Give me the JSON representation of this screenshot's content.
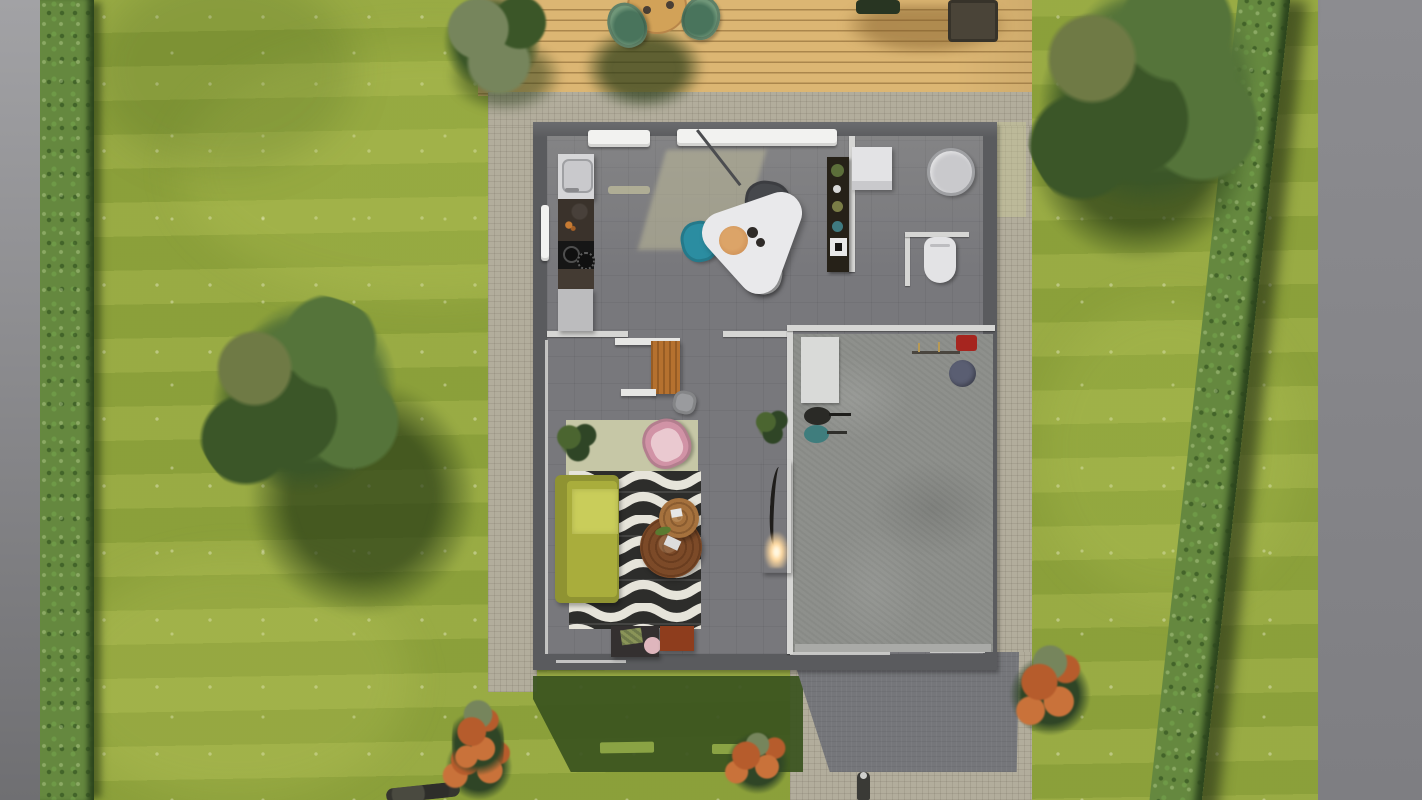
{
  "scene": {
    "title": "Aerial top-down 3D render of a single-storey house with garden, deck and garage",
    "view": "top-down orthographic",
    "palette": {
      "gray_left": "#a2a2a5",
      "gray_left_dark": "#6f6f72",
      "gray_right": "#8c8c90",
      "lawn": "#94a73e",
      "speckle": "rgba(246,246,224,0.38)",
      "speckle2": "rgba(255,255,235,0.30)",
      "hedge": "#65883f",
      "hedge_dark": "#2c451d",
      "deck": "#dcb673",
      "deck_line": "rgba(130,95,45,0.55)",
      "deck_table": "#d2a258",
      "deck_chair": "#6f9678",
      "deck_chair_dark": "#49745c",
      "deck_furniture_dark": "#283522",
      "deck_furniture_brown": "#4a4438",
      "concrete": "#b2ad9c",
      "concrete_line": "rgba(90,85,70,0.14)",
      "shadow_green": "#3a531e",
      "shadow_slit": "#8aa344",
      "driveway": "#75767a",
      "wall": "#5a5b5e",
      "wall_inner": "#d6d6d4",
      "floor": "#78787c",
      "floor_light_patch": "rgba(203,200,160,0.45)",
      "window_white": "#f2f2f0",
      "garage_floor": "#8e908c",
      "garage_mat": "#d9dad8",
      "fixture_white": "#e3e3e5",
      "fixture_gray": "#c9c9cc",
      "basin_ring": "#9fa0a3",
      "sink_white": "#d6d6d8",
      "counter_dark": "#3a322b",
      "cooktop": "#161616",
      "cabinet_light": "#bcbcbe",
      "table_white": "#e9e9eb",
      "chair_teal": "#2b8da1",
      "chair_dark_gray": "#46484c",
      "chair_white": "#dadbdd",
      "plate": "#cf9157",
      "shelf_dark": "#262118",
      "desk_orange": "#b5712f",
      "shelf_white": "#e6e6e4",
      "rug_beige": "#c6c7a6",
      "chair_pink": "#d193a6",
      "chair_pink_light": "#eac9d0",
      "rug_black": "#2d2d2b",
      "rug_white": "#e6e4da",
      "sofa": "#a9ad3c",
      "sofa_light": "#c9cd5a",
      "sofa_dark": "#8f9332",
      "wood_dark": "#7c4a28",
      "wood_light": "#a5713d",
      "console_dark": "#343030",
      "rust": "#8e3d1d",
      "fireplace": "#c1661f",
      "flame": "#ffd9a0",
      "plant_dark": "#2f4526",
      "plant_green": "#4b6530",
      "tree_green": "#55743a",
      "tree_green_dark": "#3b5628",
      "tree_olive": "#6f7a45",
      "tree_shadow": "rgba(36,56,20,0.85)",
      "shrub_gray": "#76855c",
      "bush_orange": "#b65c2c",
      "bush_orange2": "#c9723a",
      "vac_black": "#2a2a26",
      "vac_teal": "#3f7d7d",
      "navy": "#5a5e72",
      "red_item": "#a6251f",
      "figure_dark": "#3a3a36"
    },
    "exterior": {
      "ground": [
        "lawn with daisy speckles",
        "gray boundary strip left",
        "gray boundary area right",
        "left hedge row",
        "diagonal right hedge row",
        "concrete tile apron around house",
        "dark driveway bottom-right",
        "house shadow on lawn with two window light slits"
      ],
      "deck": {
        "objects": [
          "round wooden table",
          "two cups",
          "green shell chair left",
          "green shell chair right",
          "dark lounger (edge of frame)",
          "dark brown side furniture (edge of frame)",
          "chair shadows"
        ]
      },
      "plants": [
        "large tree on left lawn",
        "large tree top-right",
        "gray-green shrub overhanging deck top-left",
        "red flowering bush bottom-left",
        "red flowering bush bottom-center",
        "flowering bush bottom-right",
        "corner shrub at apron bottom-left"
      ],
      "props": [
        "small statue on path below driveway",
        "dark object at bottom-left edge"
      ]
    },
    "house": {
      "architecture": [
        "dark perimeter walls",
        "two top windows",
        "left wall window",
        "interior partition walls",
        "wc enclosure walls",
        "door openings",
        "white wall-top highlights"
      ],
      "kitchen": {
        "objects": [
          "sink unit with basin",
          "dark stone counter",
          "black cooktop with burners",
          "dark counter section",
          "light base cabinet"
        ]
      },
      "dining": {
        "objects": [
          "white triangular table",
          "teal chair",
          "dark gray chair",
          "white chair",
          "wooden plate with cups",
          "pendant lamp cable",
          "tall dark shelf with decor",
          "sunlight patch on floor"
        ]
      },
      "bathroom": {
        "objects": [
          "white washing machine",
          "round shower basin",
          "toilet"
        ]
      },
      "living_room": {
        "objects": [
          "white wall shelves",
          "orange wood desk",
          "gray desk chair",
          "beige area rug",
          "pink armchair",
          "houseplant left",
          "black & white wave rug",
          "chartreuse sofa with throw",
          "large round coffee table",
          "small round coffee table",
          "dark media console with decor",
          "rust storage cube",
          "orange fireplace with flame",
          "potted plant by wall"
        ]
      },
      "garage": {
        "objects": [
          "white floor mat",
          "red wall-mounted box",
          "tool rail",
          "dark blue bucket",
          "black canister vacuum",
          "teal canister vacuum"
        ]
      }
    }
  }
}
